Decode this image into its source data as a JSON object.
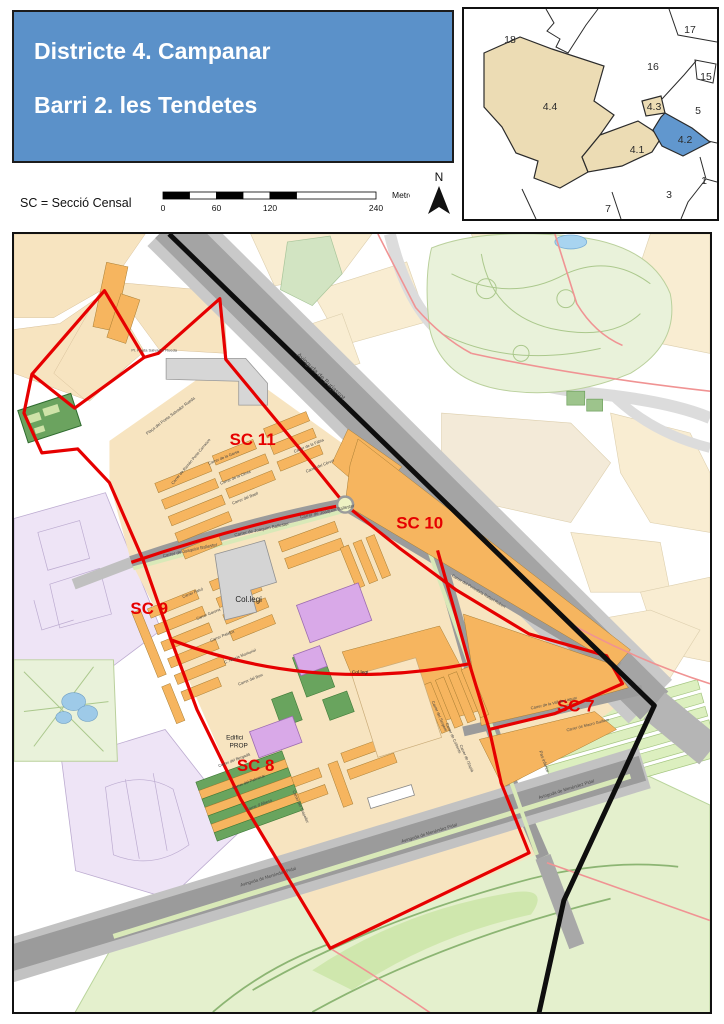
{
  "header": {
    "line1": "Districte 4. Campanar",
    "line2": "Barri 2. les Tendetes"
  },
  "legend": {
    "sc_note": "SC = Secció Censal",
    "scale": {
      "ticks": [
        "0",
        "60",
        "120",
        "240"
      ],
      "unit": "Metres"
    },
    "north": "N"
  },
  "inset": {
    "labels": {
      "d18": "18",
      "d17": "17",
      "d16": "16",
      "d15": "15",
      "d5": "5",
      "d1": "1",
      "d3": "3",
      "d7": "7",
      "s44": "4.4",
      "s43": "4.3",
      "s42": "4.2",
      "s41": "4.1"
    }
  },
  "map": {
    "sections": {
      "sc7": "SC 7",
      "sc8": "SC 8",
      "sc9": "SC 9",
      "sc10": "SC 10",
      "sc11": "SC 11"
    },
    "places": {
      "collegi": "Col.legi",
      "collegi2": "Col.legi",
      "edifici_line1": "Edifici",
      "edifici_line2": "PROP"
    },
    "streets": {
      "burjassot": "Avinguda de Burjassot",
      "joaquim": "Carrer de Joaquim Ballester",
      "menendez": "Avinguda de Menéndez Pidal",
      "vall_laguar": "Carrer de la Vall de Laguar",
      "mauro": "Carrer de Mauro Guillem",
      "periodista": "Carrer del Periodista Rafael Rubert",
      "pas_inferior": "Pas inferior",
      "placa_poeta": "Plaça del Poeta Salvador Rueda",
      "pl_poeta": "Pl. Poeta Salvador Rueda"
    },
    "minor_streets": [
      "Carrer de Ramón Porta Carrasco",
      "Carrer de la Garsa",
      "Carrer de la Cènia",
      "Carrer del Baell",
      "Carrer de la Fàbia",
      "Carrer del Cérvol",
      "Carrer Falcó",
      "Carrer Garona",
      "Carrer Palafox",
      "C. Narcís Monturiol",
      "Carrer del Boix",
      "Carrer del Bergadà",
      "Carrer del Palmerar",
      "Carrer d'Albesa",
      "Carrer del Tirapeller",
      "Carrer del Sergent",
      "Carrer de Cofrents",
      "Carrer de l'Esplà"
    ],
    "colors": {
      "header_bg": "#5b91c9",
      "section_boundary_red": "#e60000",
      "district_boundary_black": "#0e0e0e",
      "inset_highlight_blue": "#6197ce",
      "inset_district_tan": "#ecdcb4",
      "building_orange": "#f6b55f",
      "road_gray": "#9b9b9b",
      "park_green": "#e9f2da",
      "garden_dark_green": "#69a45e",
      "special_building_purple": "#d9a9e8",
      "urban_lavender": "#eee4f6",
      "pond_blue": "#9ecae8"
    }
  }
}
